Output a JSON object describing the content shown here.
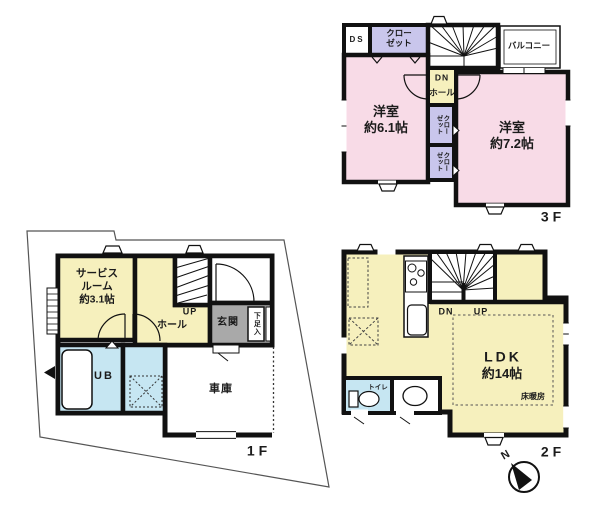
{
  "colors": {
    "pink": "#f8dbe7",
    "purple": "#c9c6ec",
    "yellow": "#f6f0bd",
    "blue": "#c6e6f2",
    "gray": "#a9a9a9",
    "wall": "#111111",
    "lot_line": "#555555"
  },
  "floor3": {
    "label": "3F",
    "ds": "DS",
    "closet_line1": "クロー",
    "closet_line2": "ゼット",
    "dn": "DN",
    "hall": "ホール",
    "balcony": "バルコニー",
    "room_a_name": "洋室",
    "room_a_size": "約6.1帖",
    "room_b_name": "洋室",
    "room_b_size": "約7.2帖",
    "closet_small_col1": "クロー",
    "closet_small_col2": "ゼット"
  },
  "floor2": {
    "label": "2F",
    "dn": "DN",
    "up": "UP",
    "toilet": "トイレ",
    "ldk_name": "LDK",
    "ldk_size": "約14帖",
    "floor_heating": "床暖房",
    "compass_north": "N"
  },
  "floor1": {
    "label": "1F",
    "service_line1": "サービス",
    "service_line2": "ルーム",
    "service_line3": "約3.1帖",
    "up": "UP",
    "hall": "ホール",
    "entrance": "玄関",
    "shoe_cabinet": "下足入",
    "unit_bath": "UB",
    "garage": "車庫"
  }
}
